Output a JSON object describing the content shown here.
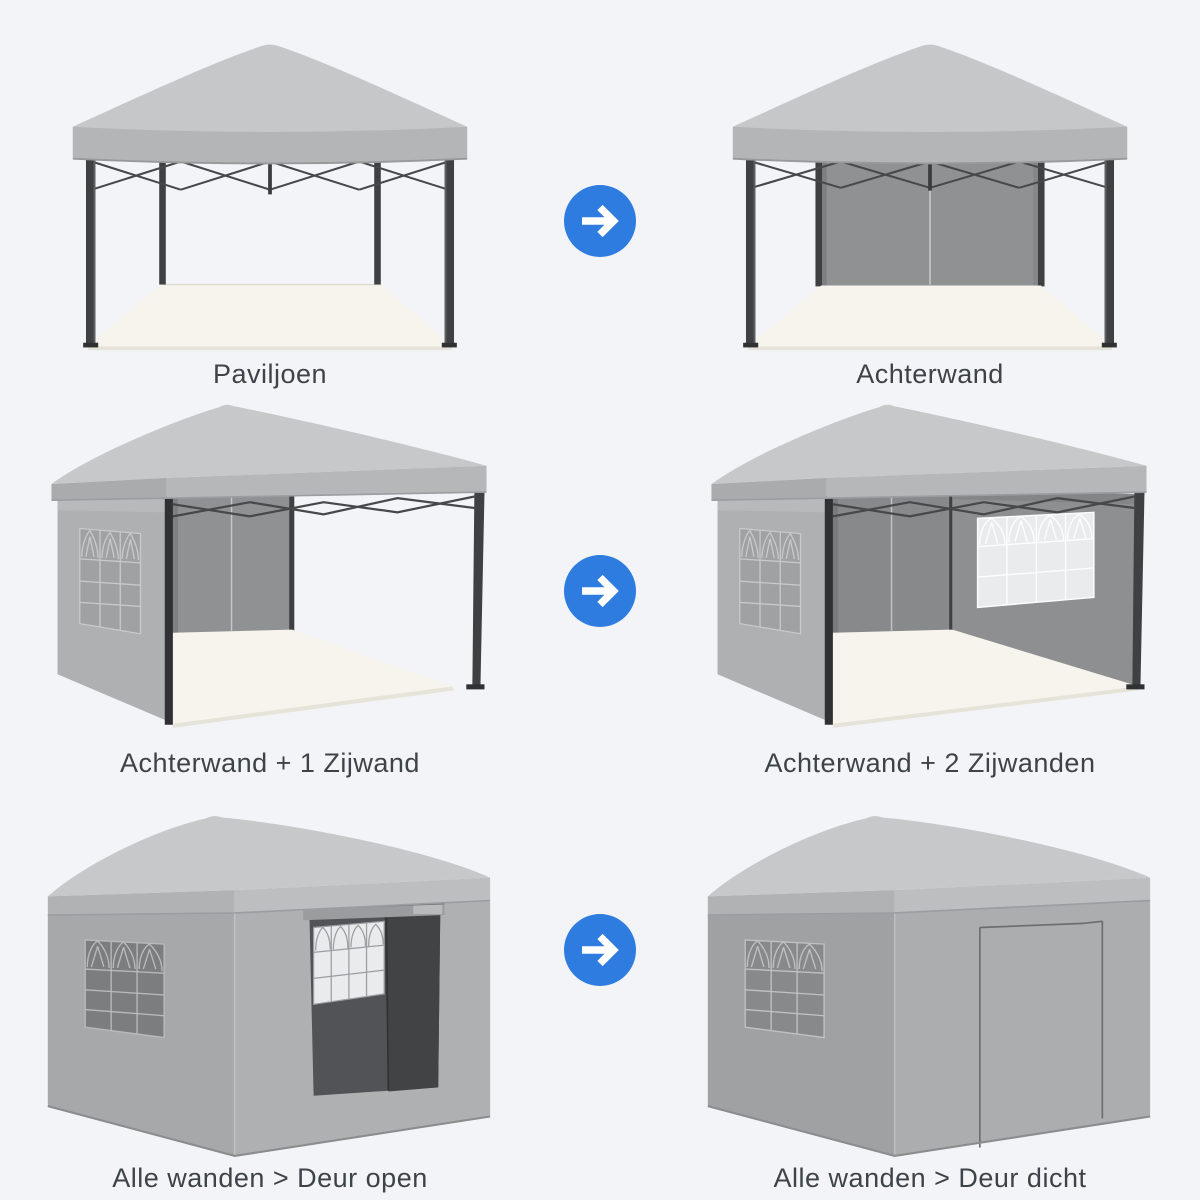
{
  "page": {
    "background_color": "#f3f4f7",
    "text_color": "#3d4348",
    "description_type": "product configuration diagram, pop-up gazebo"
  },
  "arrow_icon": {
    "name": "arrow-right-icon",
    "color": "#2e7ce0",
    "glyph_color": "#ffffff",
    "direction": "right"
  },
  "colors": {
    "canopy_gray": "#c5c7c9",
    "valance_gray": "#b3b5b7",
    "wall_gray": "#a8aaac",
    "back_wall_gray": "#8f9193",
    "frame_dark": "#3e4042",
    "floor_cream": "#f6f4ec",
    "window_light": "#eaebec",
    "interior_dark": "#4a4c4e"
  },
  "cells": [
    {
      "id": "pavilion",
      "label": "Paviljoen"
    },
    {
      "id": "back-wall",
      "label": "Achterwand"
    },
    {
      "id": "back-plus-1-side",
      "label": "Achterwand + 1 Zijwand"
    },
    {
      "id": "back-plus-2-sides",
      "label": "Achterwand + 2 Zijwanden"
    },
    {
      "id": "all-walls-door-open",
      "label": "Alle wanden > Deur open"
    },
    {
      "id": "all-walls-door-closed",
      "label": "Alle wanden > Deur dicht"
    }
  ]
}
